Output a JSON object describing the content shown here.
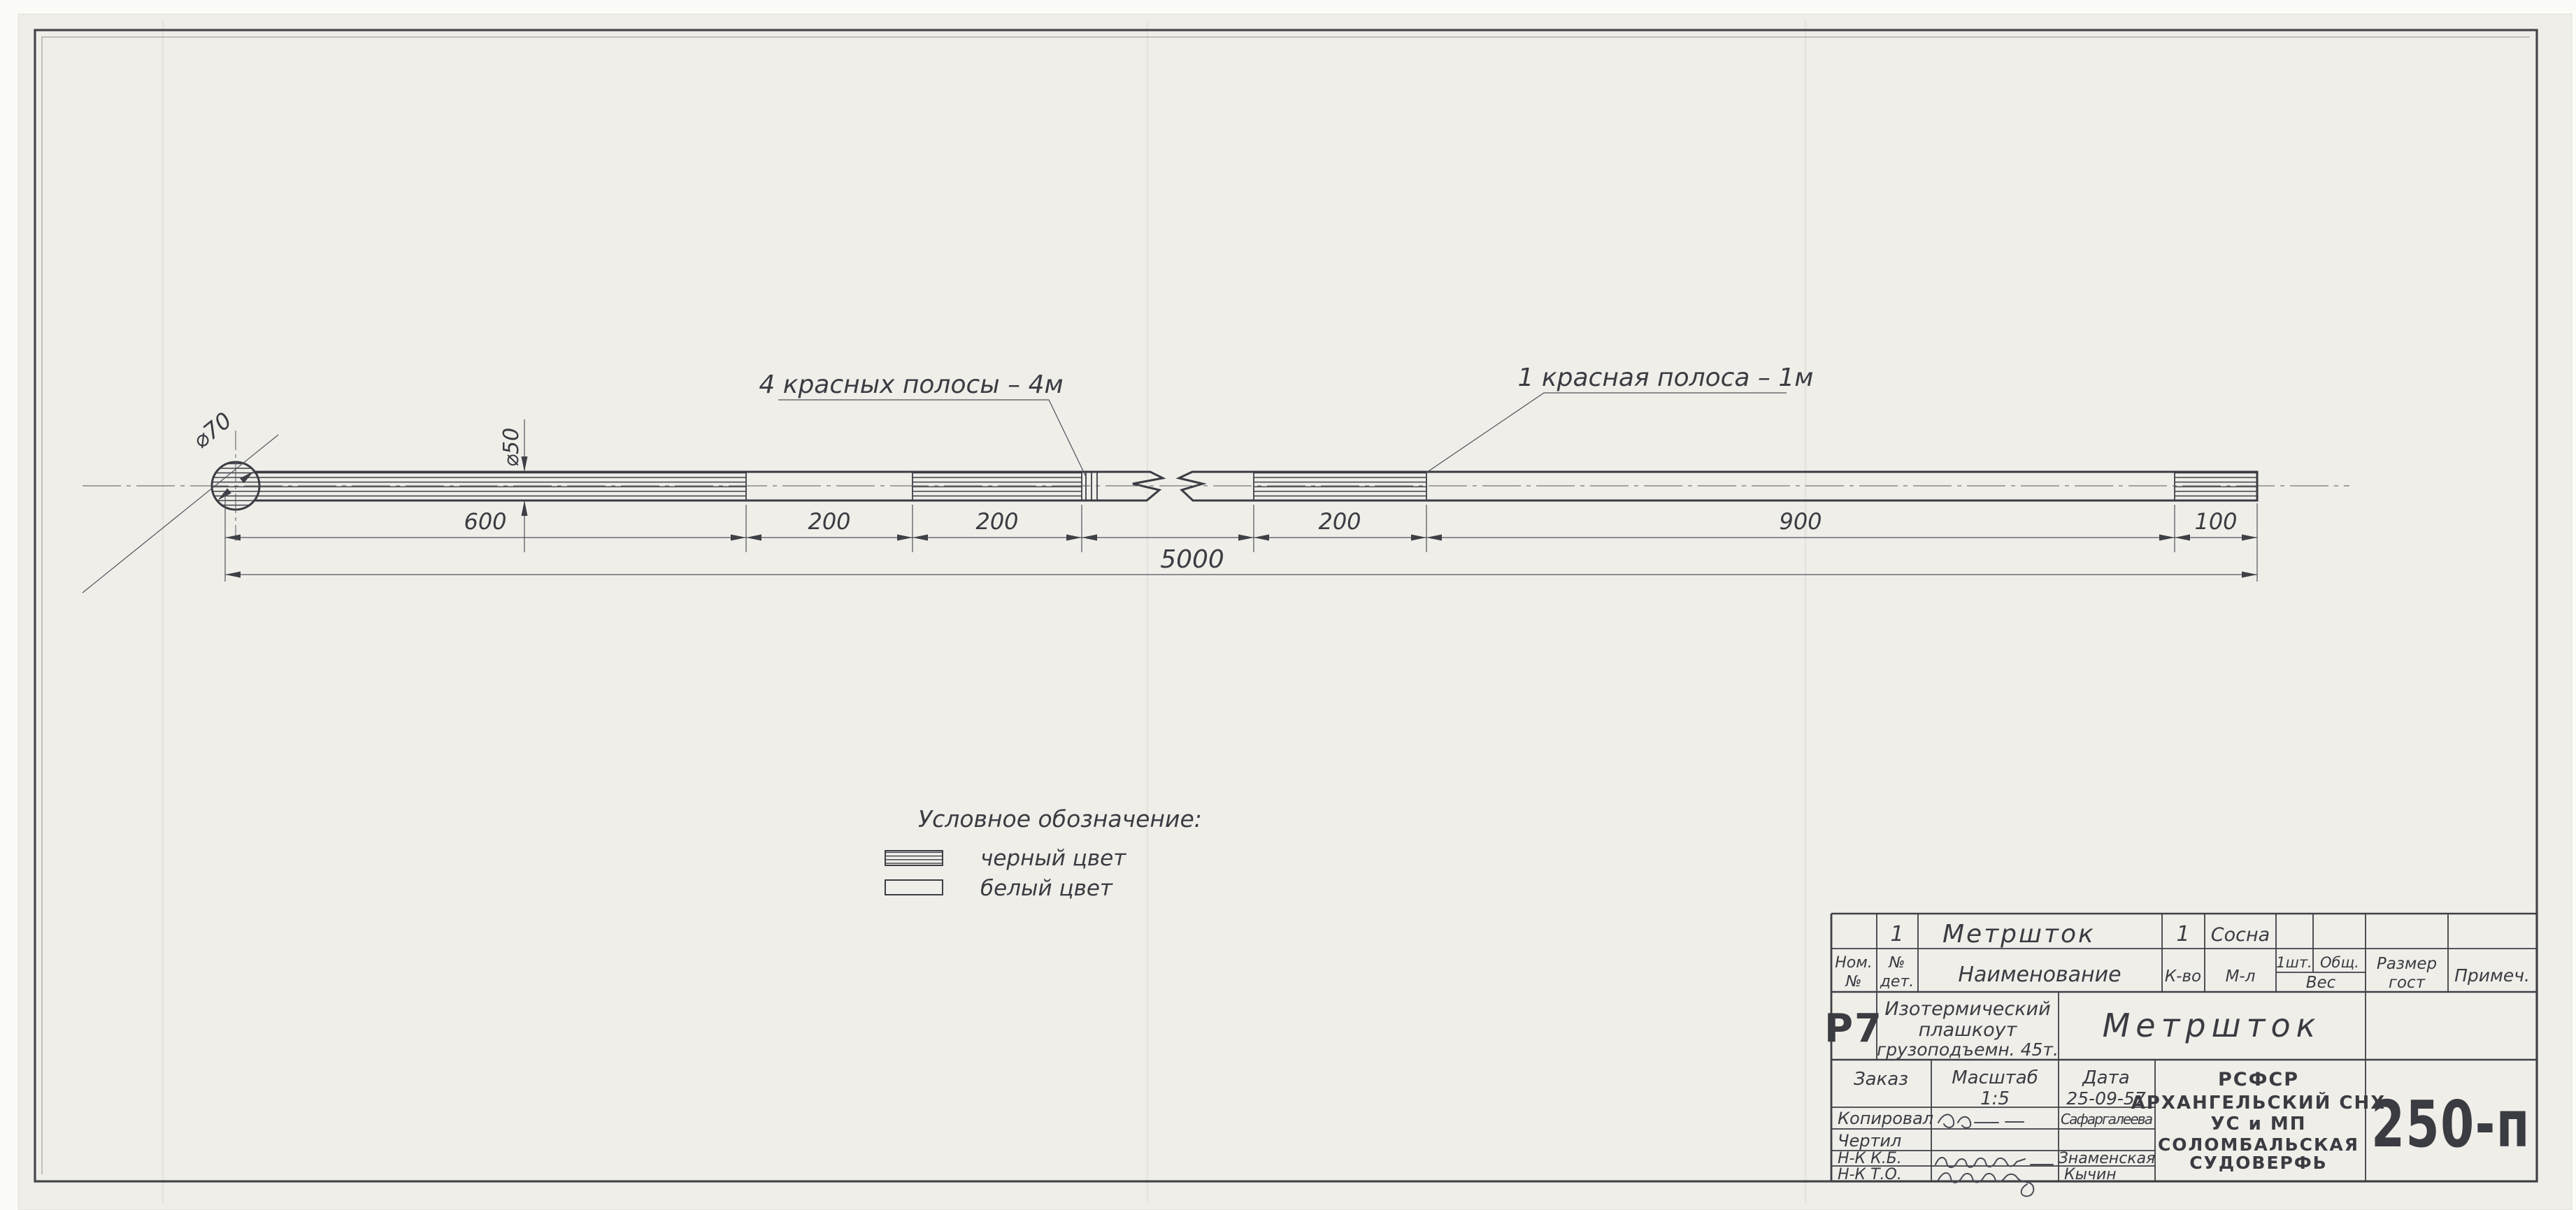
{
  "colors": {
    "paper": "#efeee9",
    "ink": "#3b3b42"
  },
  "drawing": {
    "annotation_left": "4 красных полосы – 4м",
    "annotation_right": "1 красная полоса – 1м",
    "dia_head": "⌀70",
    "dia_rod": "⌀50",
    "dims": {
      "segments": [
        "600",
        "200",
        "200",
        "200",
        "900",
        "100"
      ],
      "overall": "5000"
    },
    "legend": {
      "title": "Условное обозначение:",
      "black": "черный цвет",
      "white": "белый цвет"
    }
  },
  "title_block": {
    "item": {
      "det_no": "1",
      "name": "Метршток",
      "qty": "1",
      "material": "Сосна"
    },
    "headers": {
      "pos1": "Ном.",
      "pos2": "№",
      "det1": "№",
      "det2": "дет.",
      "name": "Наименование",
      "qty": "К-во",
      "material": "М-л",
      "per_item": "1шт.",
      "total": "Общ.",
      "weight": "Вес",
      "size1": "Размер",
      "size2": "гост",
      "note": "Примеч."
    },
    "project": {
      "code": "Р7",
      "obj1": "Изотермический",
      "obj2": "плашкоут",
      "obj3": "грузоподъемн. 45т.",
      "part": "Метршток"
    },
    "meta": {
      "order": "Заказ",
      "scale_label": "Масштаб",
      "scale": "1:5",
      "date_label": "Дата",
      "date": "25-09-57"
    },
    "roles": {
      "r1": "Копировал",
      "r2": "Чертил",
      "r3": "Н-К К.Б.",
      "r4": "Н-К Т.О."
    },
    "names": {
      "copier": "Сафаргалеева",
      "kb": "Знаменская",
      "to": "Кычин"
    },
    "org": {
      "l1": "РСФСР",
      "l2": "АРХАНГЕЛЬСКИЙ СНХ",
      "l3": "УС и МП",
      "l4": "СОЛОМБАЛЬСКАЯ",
      "l5": "СУДОВЕРФЬ"
    },
    "doc_number": "250-п"
  }
}
